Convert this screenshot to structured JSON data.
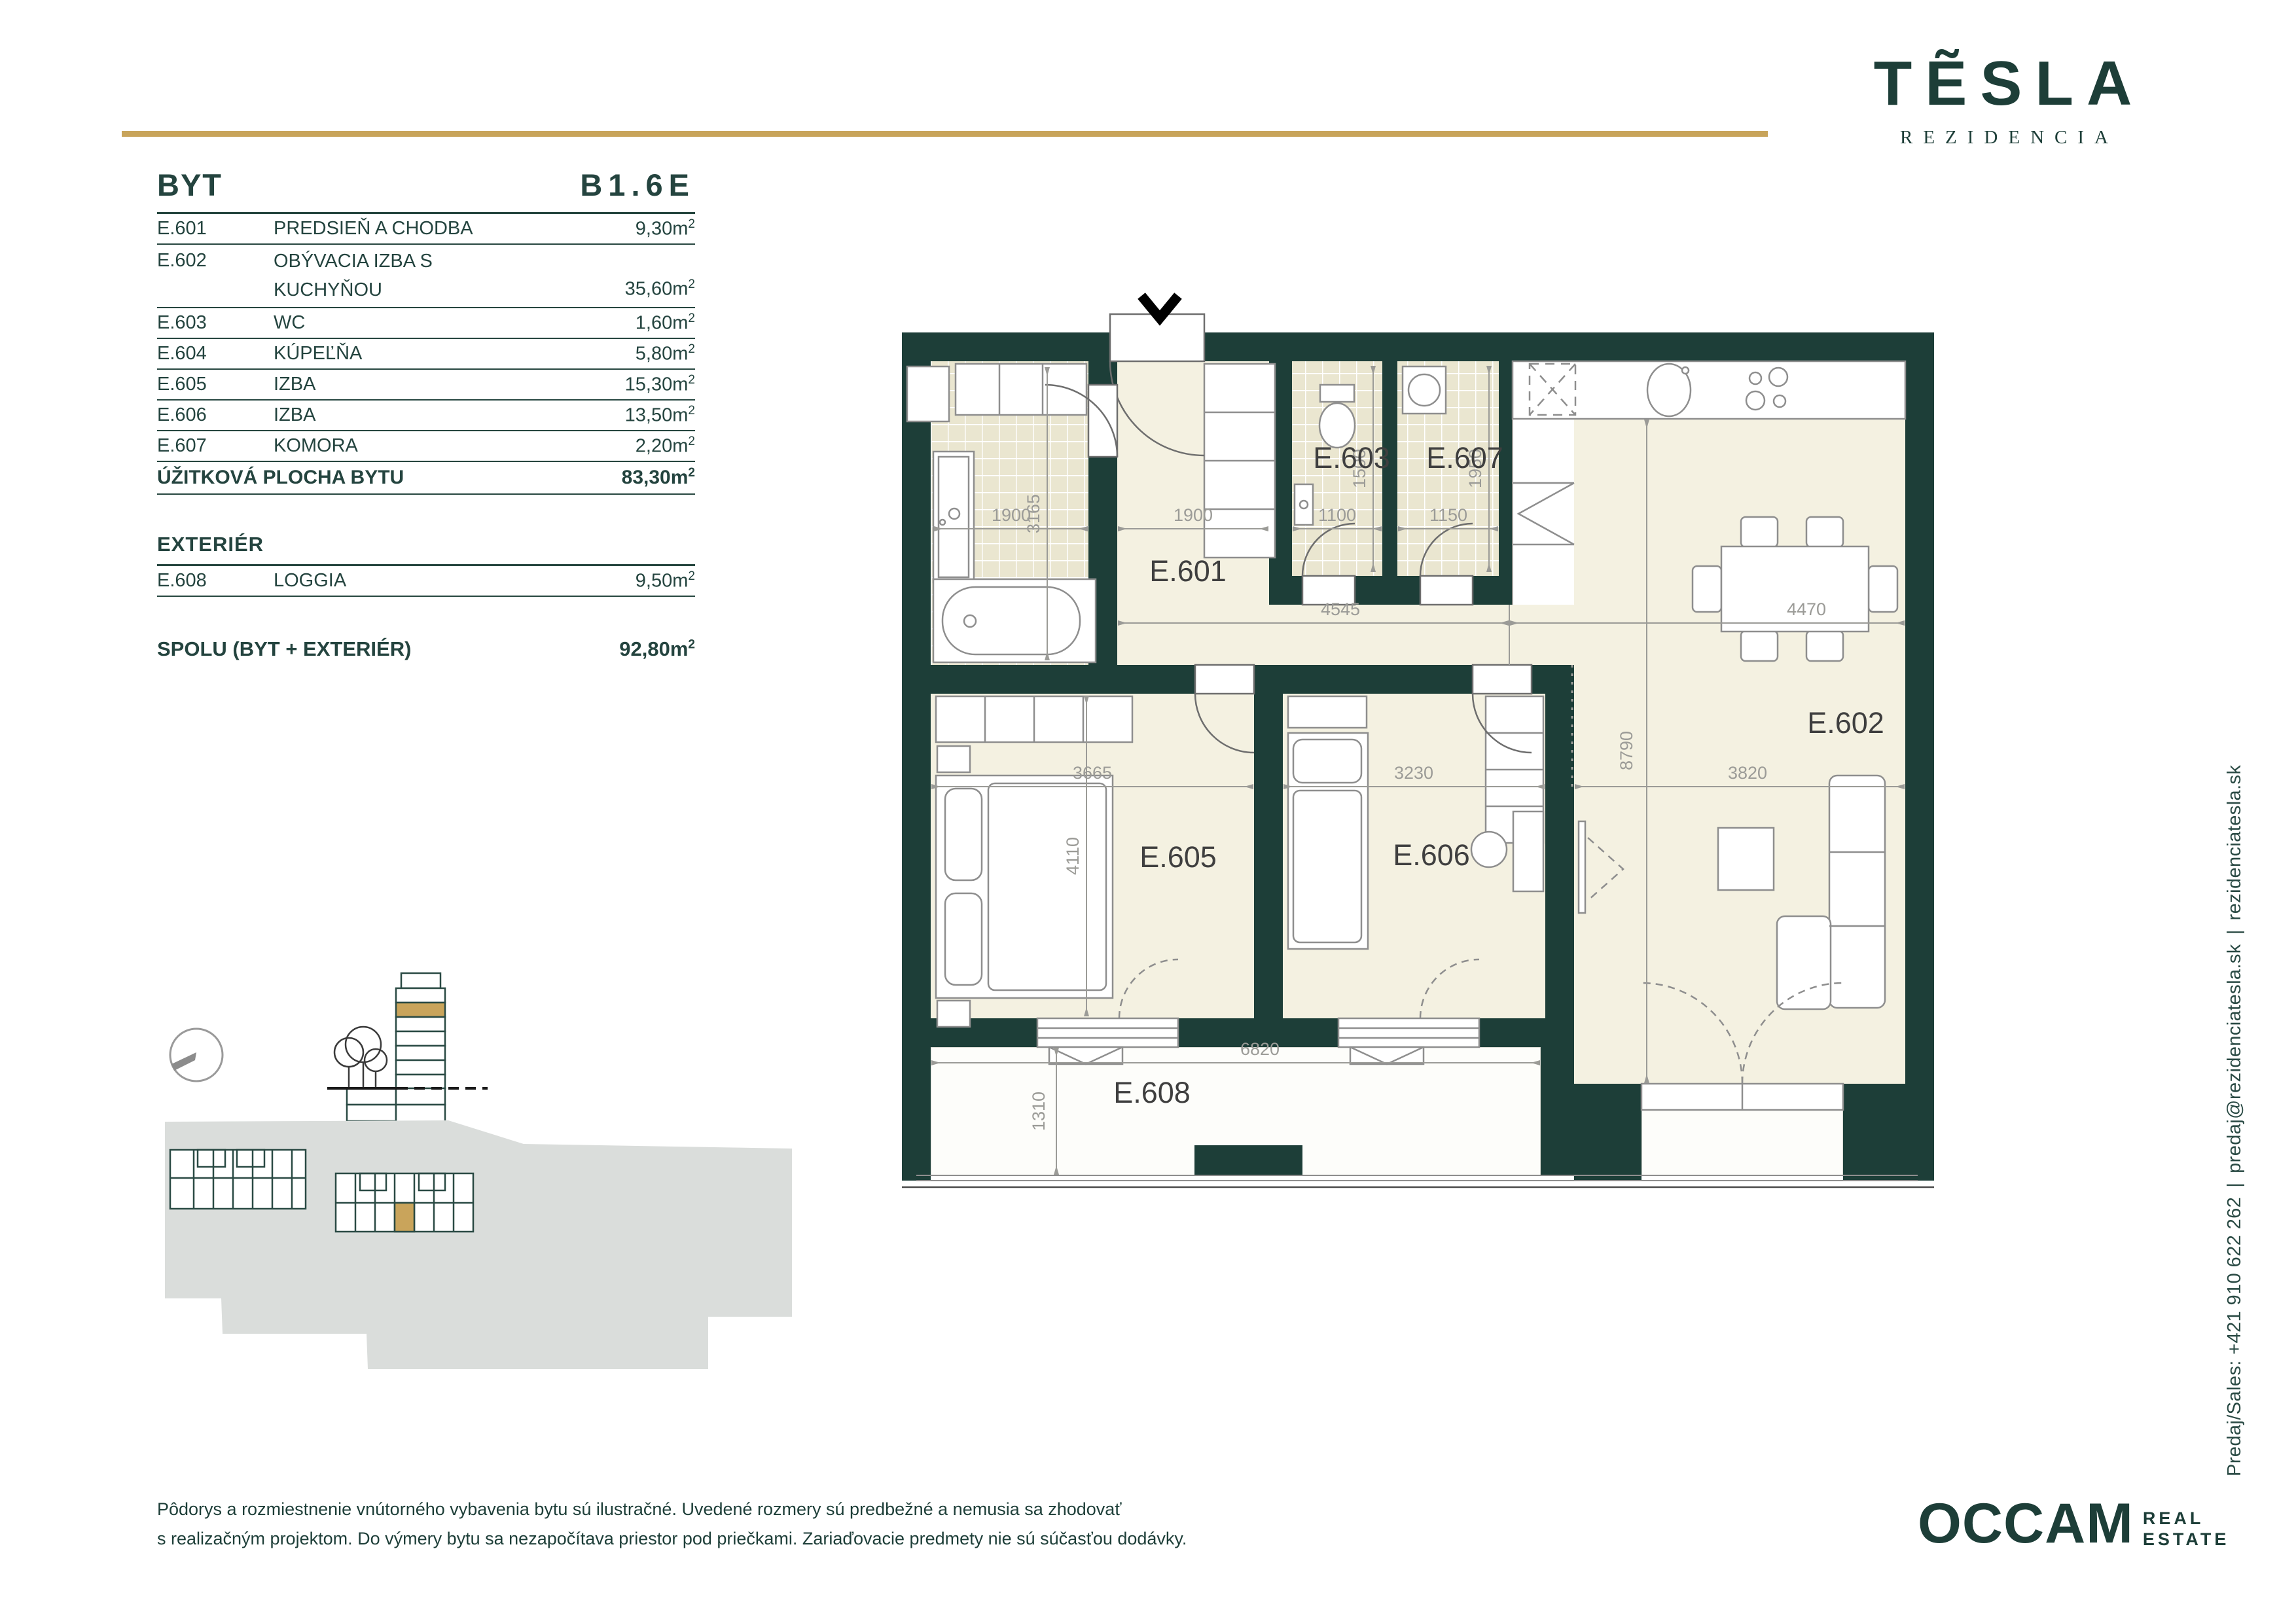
{
  "brand": {
    "logo_text": "TẼSLA",
    "logo_sub": "REZIDENCIA"
  },
  "header": {
    "byt_label": "BYT",
    "unit_code": "B1.6E"
  },
  "units": {
    "m": "m",
    "sup": "2"
  },
  "table": {
    "rows": [
      {
        "code": "E.601",
        "name": "PREDSIEŇ A CHODBA",
        "area": "9,30"
      },
      {
        "code": "E.602",
        "name": "OBÝVACIA IZBA S KUCHYŇOU",
        "area": "35,60"
      },
      {
        "code": "E.603",
        "name": "WC",
        "area": "1,60"
      },
      {
        "code": "E.604",
        "name": "KÚPEĽŇA",
        "area": "5,80"
      },
      {
        "code": "E.605",
        "name": "IZBA",
        "area": "15,30"
      },
      {
        "code": "E.606",
        "name": "IZBA",
        "area": "13,50"
      },
      {
        "code": "E.607",
        "name": "KOMORA",
        "area": "2,20"
      }
    ],
    "total_label": "ÚŽITKOVÁ PLOCHA BYTU",
    "total_area": "83,30",
    "exterier_label": "EXTERIÉR",
    "exterier_row": {
      "code": "E.608",
      "name": "LOGGIA",
      "area": "9,50"
    },
    "spolu_label": "SPOLU (BYT + EXTERIÉR)",
    "spolu_area": "92,80"
  },
  "plan": {
    "rooms": {
      "e601": "E.601",
      "e602": "E.602",
      "e603": "E.603",
      "e605": "E.605",
      "e606": "E.606",
      "e607": "E.607",
      "e608": "E.608"
    },
    "dims": {
      "bath_w": "1900",
      "hall_w": "1900",
      "wc_w": "1100",
      "komora_w": "1150",
      "bath_h": "3165",
      "wc_h": "1500",
      "komora_h": "1950",
      "hall_l": "4545",
      "living_top": "4470",
      "e605_w": "3665",
      "e606_w": "3230",
      "living_w": "3820",
      "living_h": "8790",
      "e605_h": "4110",
      "loggia_w": "6820",
      "loggia_h": "1310"
    }
  },
  "contact": {
    "phone": "Predaj/Sales: +421 910 622 262",
    "email": "predaj@rezidenciatesla.sk",
    "web": "rezidenciatesla.sk",
    "separator": "|"
  },
  "footer": {
    "disclaimer_line1": "Pôdorys a rozmiestnenie vnútorného vybavenia bytu sú ilustračné. Uvedené rozmery sú predbežné a nemusia sa zhodovať",
    "disclaimer_line2": "s realizačným projektom. Do výmery bytu sa nezapočítava priestor pod priečkami. Zariaďovacie predmety nie sú súčasťou dodávky.",
    "occam": "OCCAM",
    "occam_real": "REAL",
    "occam_estate": "ESTATE"
  },
  "colors": {
    "wall_teal": "#1D3E38",
    "accent_gold": "#C8A45A",
    "floor_cream": "#F4F1E1",
    "tile": "#EAE6D0",
    "site_gray": "#DADDDB"
  }
}
